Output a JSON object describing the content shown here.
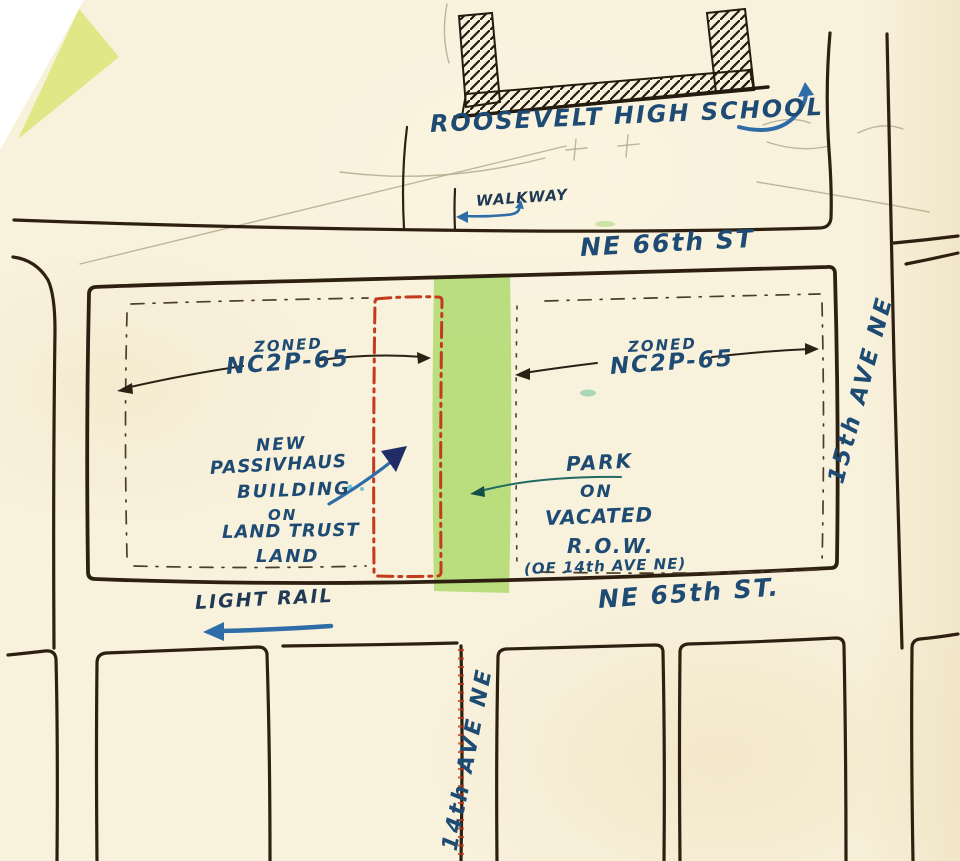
{
  "labels": {
    "school": "ROOSEVELT HIGH SCHOOL",
    "walkway": "WALKWAY",
    "street_ne66": "NE 66th ST",
    "street_ne65": "NE 65th ST.",
    "avenue_15": "15th AVE NE",
    "avenue_14": "14th AVE NE",
    "light_rail": "LIGHT RAIL",
    "zoned_left": {
      "line1": "ZONED",
      "line2": "NC2P-65"
    },
    "zoned_right": {
      "line1": "ZONED",
      "line2": "NC2P-65"
    },
    "passivhaus": {
      "line1": "NEW",
      "line2": "PASSIVHAUS",
      "line3": "BUILDING",
      "line4": "ON",
      "line5": "LAND TRUST",
      "line6": "LAND"
    },
    "park": {
      "line1": "PARK",
      "line2": "ON",
      "line3": "VACATED",
      "line4": "R.O.W.",
      "line5": "(OF 14th AVE NE)"
    }
  },
  "colors": {
    "paper": "#f8f1dc",
    "street_ink": "#2e2011",
    "blue_ink": "#1e4b73",
    "dark_blue_ink": "#203a55",
    "red_marker": "#c43a1c",
    "park_green": "#a8d964",
    "corner_yellow": "#dce57c",
    "pencil": "#b3a98e",
    "arrow_blue": "#2f6da8",
    "navy": "#1f2c66",
    "teal": "#226b63"
  }
}
